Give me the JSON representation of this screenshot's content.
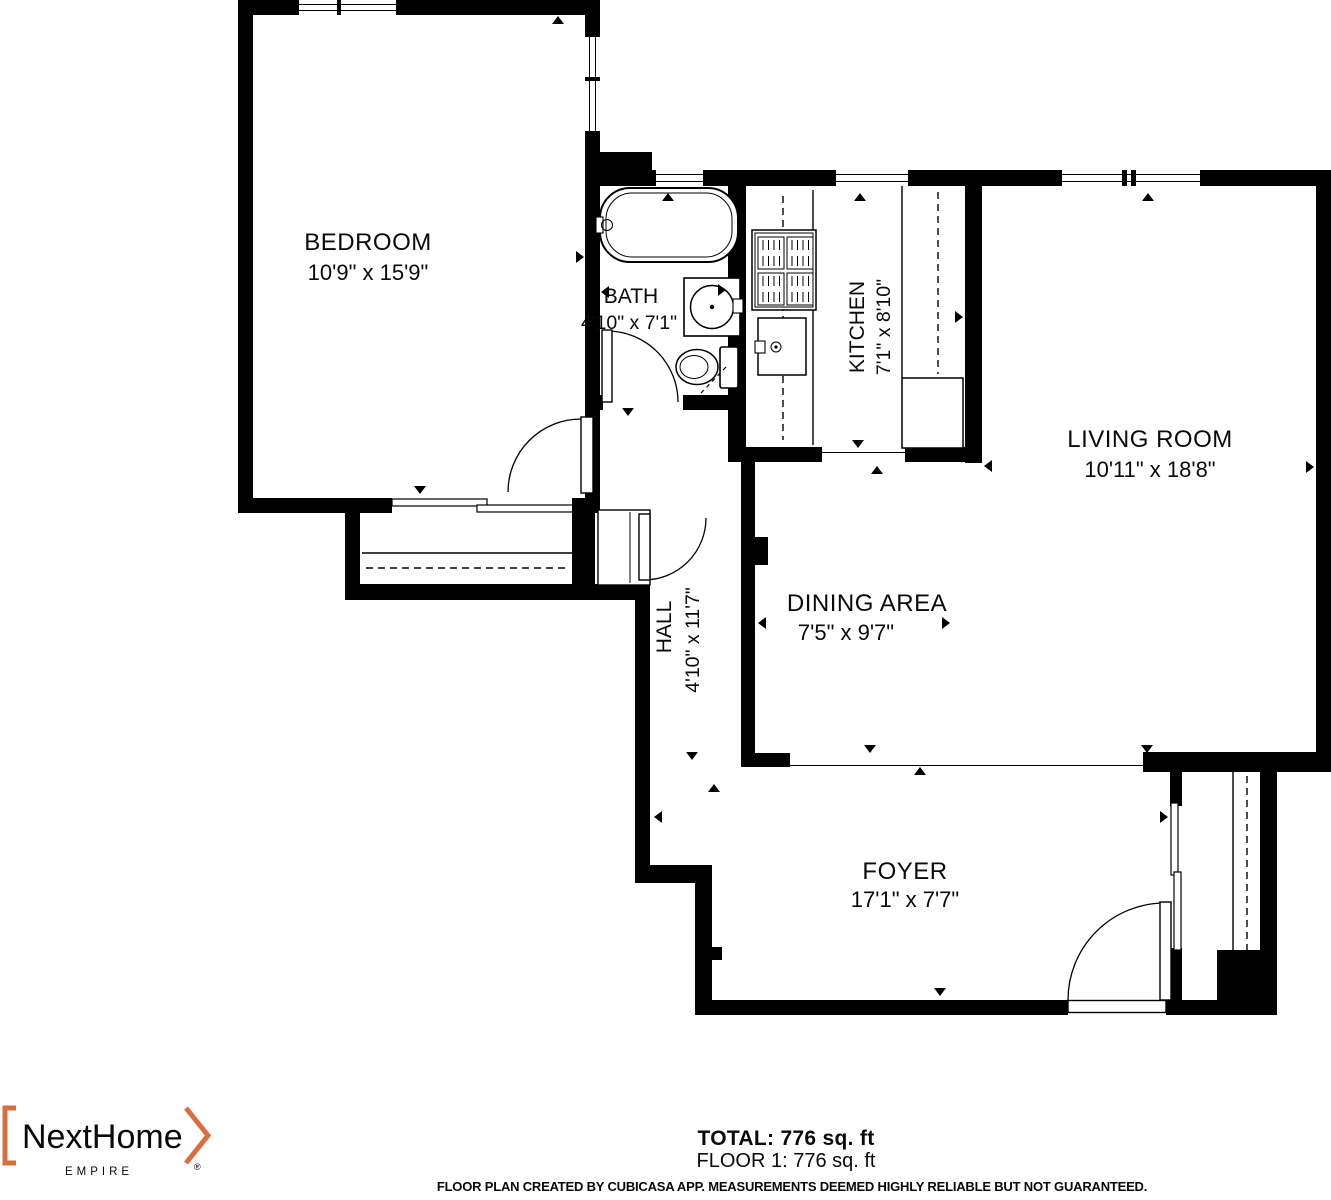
{
  "plan": {
    "rooms": [
      {
        "name": "BEDROOM",
        "dims": "10'9\" x 15'9\""
      },
      {
        "name": "BATH",
        "dims": "4'10\" x 7'1\""
      },
      {
        "name": "KITCHEN",
        "dims": "7'1\" x 8'10\""
      },
      {
        "name": "LIVING ROOM",
        "dims": "10'11\" x 18'8\""
      },
      {
        "name": "HALL",
        "dims": "4'10\" x 11'7\""
      },
      {
        "name": "DINING AREA",
        "dims": "7'5\" x 9'7\""
      },
      {
        "name": "FOYER",
        "dims": "17'1\" x 7'7\""
      }
    ],
    "wall_color": "#000000"
  },
  "summary": {
    "total": "TOTAL: 776 sq. ft",
    "floor": "FLOOR 1: 776 sq. ft"
  },
  "disclaimer": "FLOOR PLAN CREATED BY CUBICASA APP. MEASUREMENTS DEEMED HIGHLY RELIABLE BUT NOT GUARANTEED.",
  "branding": {
    "logo_text": "NextHome",
    "logo_sub": "EMPIRE",
    "logo_registered": "®",
    "logo_orange": "#DB6E3E",
    "logo_gray": "#8E8E90"
  }
}
